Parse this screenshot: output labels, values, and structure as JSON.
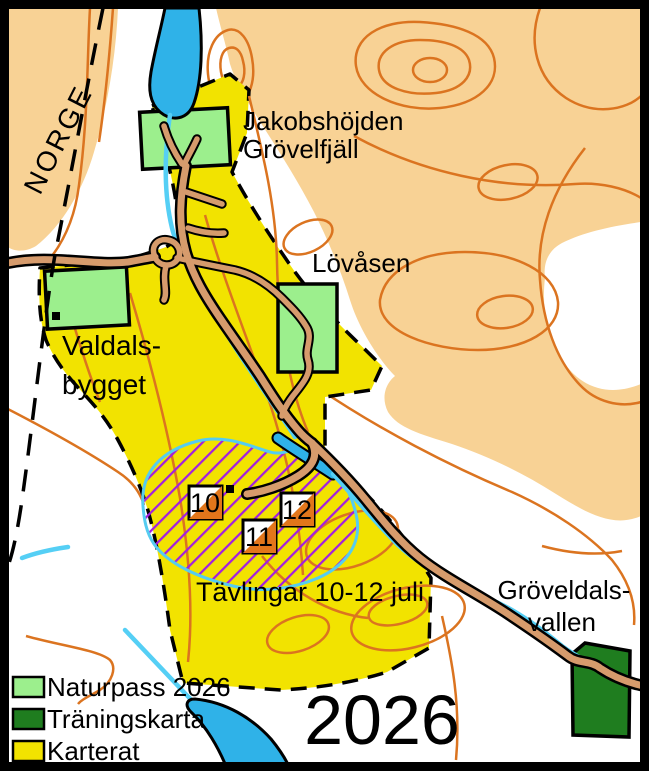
{
  "map": {
    "region_label": "NORGE",
    "year_watermark": "2026",
    "event_label": "Tävlingar 10-12 juli",
    "places": {
      "jakobshojden_line1": "Jakobshöjden",
      "jakobshojden_line2": "Grövelfjäll",
      "lovasen": "Lövåsen",
      "valdalsbygget_line1": "Valdals-",
      "valdalsbygget_line2": "bygget",
      "groveldalsvallen_line1": "Gröveldals-",
      "groveldalsvallen_line2": "vallen"
    },
    "controls": [
      {
        "number": "10"
      },
      {
        "number": "11"
      },
      {
        "number": "12"
      }
    ]
  },
  "legend": {
    "items": [
      {
        "label": "Naturpass 2026",
        "color": "#9CEF8D"
      },
      {
        "label": "Träningskarta",
        "color": "#1F7D1F"
      },
      {
        "label": "Karterat",
        "color": "#F2E300"
      }
    ]
  },
  "colors": {
    "terrain_open": "#F8D295",
    "contour_orange": "#DB7420",
    "karterat_yellow": "#F2E300",
    "naturpass_green": "#9CEF8D",
    "traningskarta_green": "#1F7D1F",
    "water_blue": "#2FB2E8",
    "stream_cyan": "#55CFF5",
    "road_brown": "#D69B6C",
    "competition_hatch_purple": "#A21FE0",
    "control_orange": "#E2761B",
    "year_green": "#1F7D1F"
  }
}
